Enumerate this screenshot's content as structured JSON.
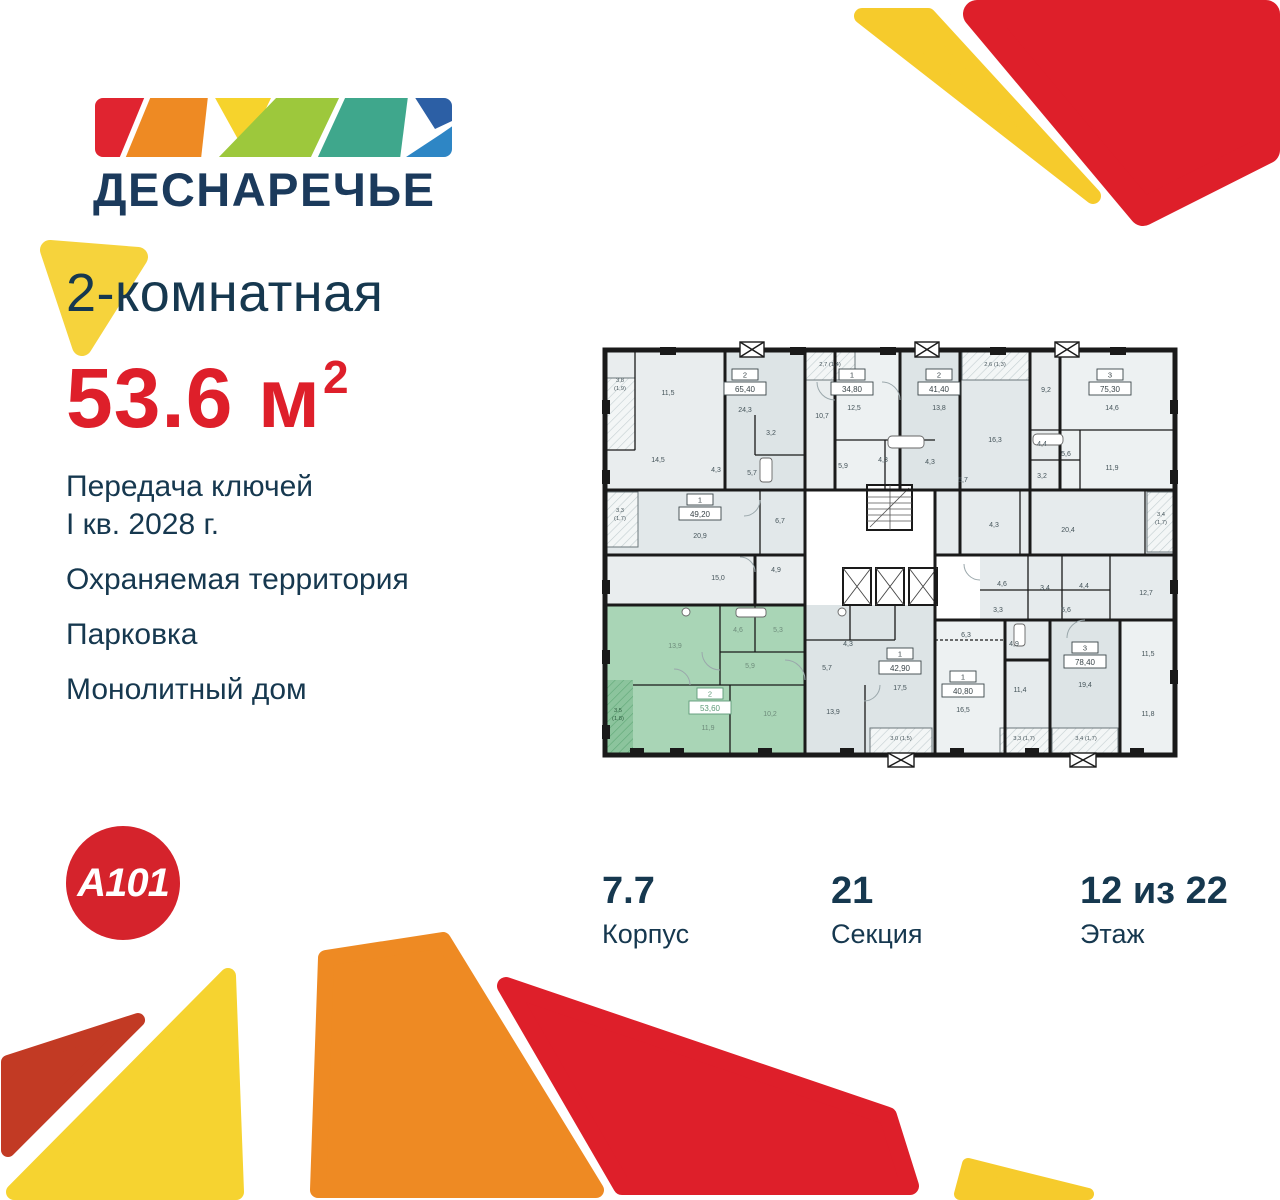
{
  "brand": {
    "wordmark": "ДЕСНАРЕЧЬЕ",
    "developer_logo": "A101"
  },
  "listing": {
    "title": "2-комнатная",
    "area_value": "53.6",
    "area_unit": "м",
    "area_sup": "2",
    "features": [
      "Передача ключей\nI кв. 2028 г.",
      "Охраняемая территория",
      "Парковка",
      "Монолитный дом"
    ]
  },
  "details": [
    {
      "value": "7.7",
      "label": "Корпус"
    },
    {
      "value": "21",
      "label": "Секция"
    },
    {
      "value": "12 из 22",
      "label": "Этаж"
    }
  ],
  "colors": {
    "navy": "#16384F",
    "red": "#DE1F2A",
    "yellow": "#F6D33C",
    "orange": "#EE8A23",
    "dark_red": "#C23A24",
    "plan_green": "#A9D5B6",
    "plan_wall": "#1A1A1A"
  },
  "floorplan": {
    "highlighted_unit": {
      "rooms": "2",
      "area": "53,60"
    },
    "unit_boxes": [
      {
        "num": "2",
        "area": "65,40",
        "x": 155,
        "y": 52
      },
      {
        "num": "1",
        "area": "34,80",
        "x": 262,
        "y": 52
      },
      {
        "num": "2",
        "area": "41,40",
        "x": 349,
        "y": 52
      },
      {
        "num": "3",
        "area": "75,30",
        "x": 520,
        "y": 52
      },
      {
        "num": "1",
        "area": "49,20",
        "x": 110,
        "y": 177
      },
      {
        "num": "2",
        "area": "53,60",
        "x": 120,
        "y": 371,
        "hl": true
      },
      {
        "num": "1",
        "area": "42,90",
        "x": 310,
        "y": 331
      },
      {
        "num": "1",
        "area": "40,80",
        "x": 373,
        "y": 354
      },
      {
        "num": "3",
        "area": "78,40",
        "x": 495,
        "y": 325
      }
    ],
    "room_labels": [
      {
        "t": "3,8",
        "x": 30,
        "y": 42,
        "c": "b"
      },
      {
        "t": "(1,9)",
        "x": 30,
        "y": 50,
        "c": "b"
      },
      {
        "t": "11,5",
        "x": 78,
        "y": 55
      },
      {
        "t": "24,3",
        "x": 155,
        "y": 72
      },
      {
        "t": "14,5",
        "x": 68,
        "y": 122
      },
      {
        "t": "4,3",
        "x": 126,
        "y": 132
      },
      {
        "t": "5,7",
        "x": 162,
        "y": 135
      },
      {
        "t": "3,2",
        "x": 181,
        "y": 95
      },
      {
        "t": "2,7 (1,4)",
        "x": 240,
        "y": 26,
        "c": "b"
      },
      {
        "t": "10,7",
        "x": 232,
        "y": 78
      },
      {
        "t": "12,5",
        "x": 264,
        "y": 70
      },
      {
        "t": "5,9",
        "x": 253,
        "y": 128
      },
      {
        "t": "4,3",
        "x": 293,
        "y": 122
      },
      {
        "t": "4,3",
        "x": 340,
        "y": 124
      },
      {
        "t": "13,8",
        "x": 349,
        "y": 70
      },
      {
        "t": "5,7",
        "x": 373,
        "y": 142
      },
      {
        "t": "2,6 (1,3)",
        "x": 405,
        "y": 26,
        "c": "b"
      },
      {
        "t": "16,3",
        "x": 405,
        "y": 102
      },
      {
        "t": "9,2",
        "x": 456,
        "y": 52
      },
      {
        "t": "4,4",
        "x": 452,
        "y": 106
      },
      {
        "t": "5,6",
        "x": 476,
        "y": 116
      },
      {
        "t": "3,2",
        "x": 452,
        "y": 138
      },
      {
        "t": "14,6",
        "x": 522,
        "y": 70
      },
      {
        "t": "11,9",
        "x": 522,
        "y": 130
      },
      {
        "t": "3,3",
        "x": 30,
        "y": 172,
        "c": "b"
      },
      {
        "t": "(1,7)",
        "x": 30,
        "y": 180,
        "c": "b"
      },
      {
        "t": "20,9",
        "x": 110,
        "y": 198
      },
      {
        "t": "6,7",
        "x": 190,
        "y": 183
      },
      {
        "t": "4,3",
        "x": 404,
        "y": 187
      },
      {
        "t": "20,4",
        "x": 478,
        "y": 192
      },
      {
        "t": "3,4",
        "x": 571,
        "y": 176,
        "c": "b"
      },
      {
        "t": "(1,7)",
        "x": 571,
        "y": 184,
        "c": "b"
      },
      {
        "t": "15,0",
        "x": 128,
        "y": 240
      },
      {
        "t": "4,9",
        "x": 186,
        "y": 232
      },
      {
        "t": "4,6",
        "x": 412,
        "y": 246
      },
      {
        "t": "3,4",
        "x": 455,
        "y": 250
      },
      {
        "t": "4,4",
        "x": 494,
        "y": 248
      },
      {
        "t": "12,7",
        "x": 556,
        "y": 255
      },
      {
        "t": "3,3",
        "x": 408,
        "y": 272
      },
      {
        "t": "5,6",
        "x": 476,
        "y": 272
      },
      {
        "t": "13,9",
        "x": 85,
        "y": 308,
        "c": "g"
      },
      {
        "t": "4,6",
        "x": 148,
        "y": 292,
        "c": "g"
      },
      {
        "t": "5,3",
        "x": 188,
        "y": 292,
        "c": "g"
      },
      {
        "t": "5,9",
        "x": 160,
        "y": 328,
        "c": "g"
      },
      {
        "t": "3,5",
        "x": 28,
        "y": 372,
        "c": "gb"
      },
      {
        "t": "(1,8)",
        "x": 28,
        "y": 380,
        "c": "gb"
      },
      {
        "t": "11,9",
        "x": 118,
        "y": 390,
        "c": "g"
      },
      {
        "t": "10,2",
        "x": 180,
        "y": 376,
        "c": "g"
      },
      {
        "t": "5,7",
        "x": 237,
        "y": 330
      },
      {
        "t": "4,3",
        "x": 258,
        "y": 306
      },
      {
        "t": "13,9",
        "x": 243,
        "y": 374
      },
      {
        "t": "17,5",
        "x": 310,
        "y": 350
      },
      {
        "t": "3,0 (1,5)",
        "x": 311,
        "y": 400,
        "c": "b"
      },
      {
        "t": "6,3",
        "x": 376,
        "y": 297
      },
      {
        "t": "16,5",
        "x": 373,
        "y": 372
      },
      {
        "t": "4,9",
        "x": 424,
        "y": 306
      },
      {
        "t": "11,4",
        "x": 430,
        "y": 352
      },
      {
        "t": "19,4",
        "x": 495,
        "y": 347
      },
      {
        "t": "11,5",
        "x": 558,
        "y": 316
      },
      {
        "t": "11,8",
        "x": 558,
        "y": 376
      },
      {
        "t": "3,3 (1,7)",
        "x": 434,
        "y": 400,
        "c": "b"
      },
      {
        "t": "3,4 (1,7)",
        "x": 496,
        "y": 400,
        "c": "b"
      }
    ]
  }
}
